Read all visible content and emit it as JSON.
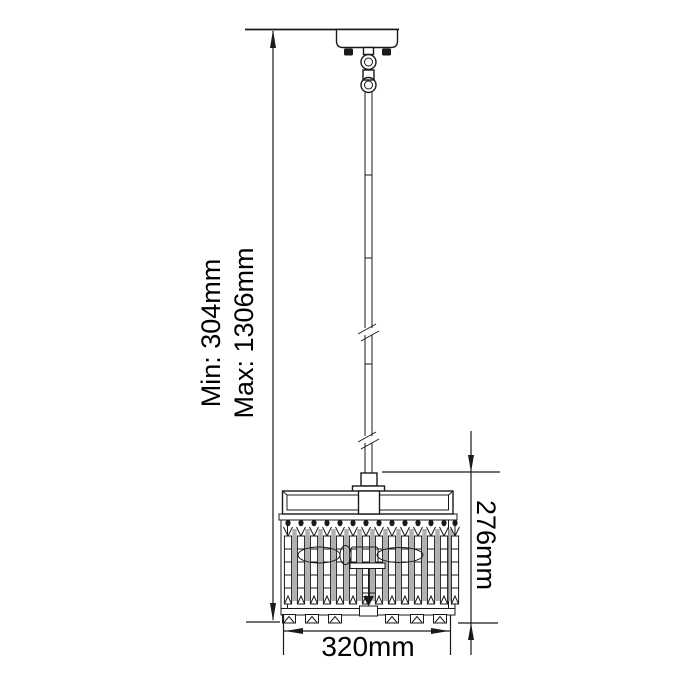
{
  "diagram": {
    "labels": {
      "height_min": "Min: 304mm",
      "height_max": "Max: 1306mm",
      "shade_height": "276mm",
      "shade_width": "320mm"
    },
    "colors": {
      "line": "#1a1a1a",
      "background": "#ffffff",
      "crystal_shadow": "#b0b0b0",
      "text": "#000000"
    }
  }
}
